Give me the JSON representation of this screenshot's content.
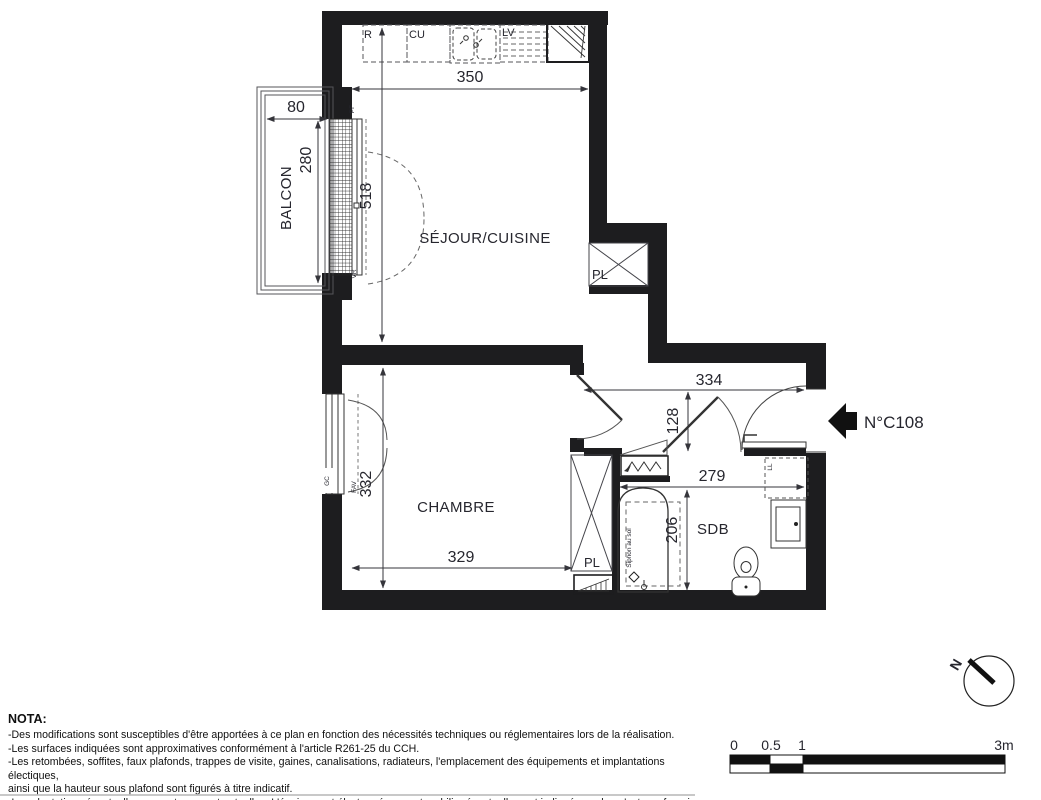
{
  "colors": {
    "wall": "#1d1d1f",
    "line": "#3f3f44",
    "text": "#26262e"
  },
  "plan": {
    "rooms": {
      "living": "SÉJOUR/CUISINE",
      "bedroom": "CHAMBRE",
      "bathroom": "SDB",
      "balcony": "BALCON"
    },
    "dimensions": {
      "living_width": "350",
      "living_depth": "518",
      "balcony_width": "80",
      "balcony_depth": "280",
      "hall_width": "334",
      "hall_depth": "128",
      "bathroom_width": "279",
      "bathroom_depth": "206",
      "bedroom_depth": "332",
      "bedroom_width": "329"
    },
    "fixtures": {
      "fridge": "R",
      "kitchen_unit": "CU",
      "dishwasher": "LV",
      "closet_living": "PL",
      "closet_bedroom": "PL",
      "washing_machine": "LL",
      "floor_drain": "Siphon au sol"
    },
    "openings": {
      "french_window": "PF",
      "roller_shutter": "VR",
      "bedroom_window": "FAV",
      "guard_rail": "GC"
    },
    "entrance": {
      "label": "N°C108"
    }
  },
  "compass": {
    "north": "N"
  },
  "scale_bar": {
    "tick_0": "0",
    "tick_05": "0.5",
    "tick_1": "1",
    "tick_3": "3m"
  },
  "nota": {
    "title": "NOTA:",
    "lines": [
      "-Des modifications sont susceptibles d'être apportées à ce plan en fonction des nécessités techniques ou réglementaires lors de la réalisation.",
      "-Les surfaces indiquées sont approximatives conformément à l'article R261-25 du CCH.",
      "-Les retombées, soffites, faux plafonds, trappes de visite, gaines, canalisations, radiateurs, l'emplacement des équipements et implantations électiques,",
      "ainsi que la hauteur sous plafond sont figurés à titre indicatif.",
      "-Les plantations éventuelles ne sont pas contractuelles. L'équipement électroménager et mobilier éventuellement indiqué sur plan n'est pas fourni."
    ]
  }
}
